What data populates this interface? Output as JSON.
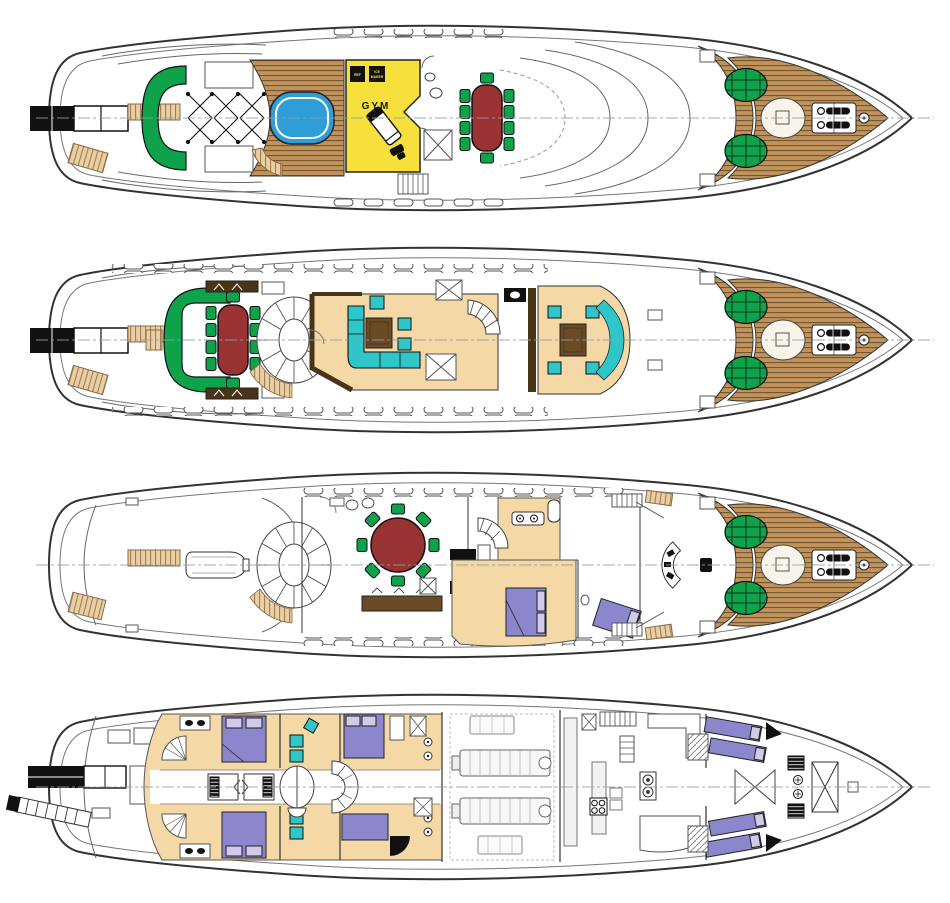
{
  "diagram": {
    "type": "yacht-general-arrangement-plans",
    "deck_count": 4,
    "decks": [
      "sun-deck",
      "bridge-deck",
      "main-deck",
      "lower-deck"
    ]
  },
  "labels": {
    "gym": "GYM",
    "ref": "REF",
    "ice_maker_line1": "ICE",
    "ice_maker_line2": "MAKER"
  },
  "palette": {
    "green": "#0EA24B",
    "table-red": "#993333",
    "gym-yellow": "#F7E03C",
    "pool-blue": "#2F9ED6",
    "teal": "#2EC6C8",
    "floor-tan": "#F4D8A5",
    "bed-purple": "#8C86CC",
    "bed-purple-light": "#CFCBE9",
    "teak-light": "#C0935C",
    "teak-dark": "#6E4F2A",
    "stair-tan": "#E9CFA4",
    "dark-brown": "#4A3418",
    "furniture-brown": "#6B4A26",
    "ink": "#111111",
    "line-gray": "#555555"
  }
}
